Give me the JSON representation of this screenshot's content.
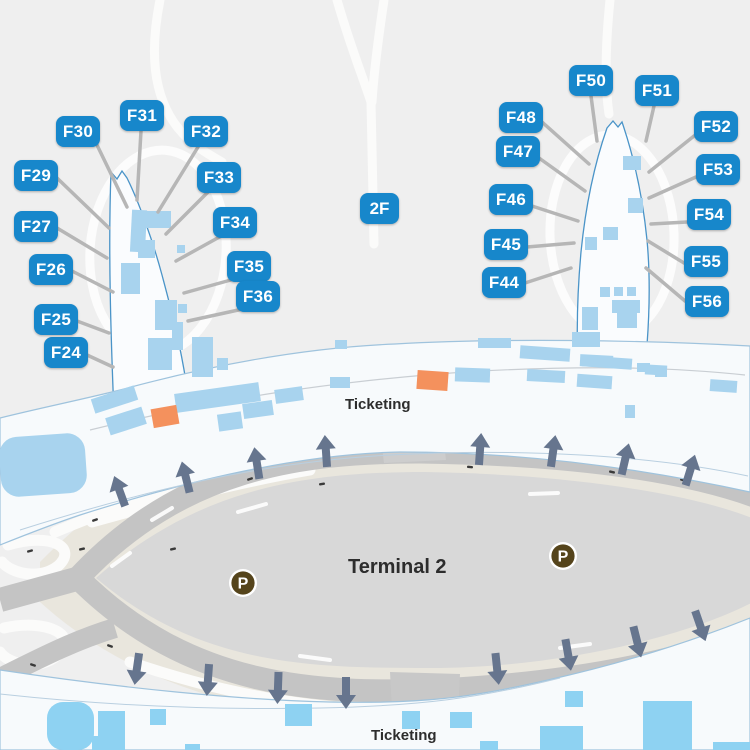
{
  "map": {
    "level_badge": "2F",
    "terminal_label": "Terminal 2",
    "ticketing_upper": "Ticketing",
    "ticketing_lower": "Ticketing",
    "parking_symbol": "P",
    "gates": [
      {
        "id": "F24",
        "x": 44,
        "y": 337,
        "line": [
          87,
          355,
          113,
          367
        ]
      },
      {
        "id": "F25",
        "x": 34,
        "y": 304,
        "line": [
          77,
          321,
          109,
          333
        ]
      },
      {
        "id": "F26",
        "x": 29,
        "y": 254,
        "line": [
          72,
          271,
          113,
          292
        ]
      },
      {
        "id": "F27",
        "x": 14,
        "y": 211,
        "line": [
          57,
          228,
          107,
          258
        ]
      },
      {
        "id": "F29",
        "x": 14,
        "y": 160,
        "line": [
          57,
          178,
          109,
          228
        ]
      },
      {
        "id": "F30",
        "x": 56,
        "y": 116,
        "line": [
          97,
          145,
          127,
          207
        ]
      },
      {
        "id": "F31",
        "x": 120,
        "y": 100,
        "line": [
          141,
          131,
          137,
          200
        ]
      },
      {
        "id": "F32",
        "x": 184,
        "y": 116,
        "line": [
          198,
          147,
          158,
          212
        ]
      },
      {
        "id": "F33",
        "x": 197,
        "y": 162,
        "line": [
          208,
          192,
          166,
          234
        ]
      },
      {
        "id": "F34",
        "x": 213,
        "y": 207,
        "line": [
          223,
          235,
          176,
          261
        ]
      },
      {
        "id": "F35",
        "x": 227,
        "y": 251,
        "line": [
          238,
          278,
          184,
          293
        ]
      },
      {
        "id": "F36",
        "x": 236,
        "y": 281,
        "line": [
          252,
          307,
          188,
          321
        ]
      },
      {
        "id": "F44",
        "x": 482,
        "y": 267,
        "line": [
          525,
          283,
          571,
          268
        ]
      },
      {
        "id": "F45",
        "x": 484,
        "y": 229,
        "line": [
          527,
          247,
          574,
          243
        ]
      },
      {
        "id": "F46",
        "x": 489,
        "y": 184,
        "line": [
          532,
          206,
          578,
          221
        ]
      },
      {
        "id": "F47",
        "x": 496,
        "y": 136,
        "line": [
          539,
          158,
          585,
          191
        ]
      },
      {
        "id": "F48",
        "x": 499,
        "y": 102,
        "line": [
          542,
          122,
          589,
          164
        ]
      },
      {
        "id": "F50",
        "x": 569,
        "y": 65,
        "line": [
          591,
          96,
          597,
          141
        ]
      },
      {
        "id": "F51",
        "x": 635,
        "y": 75,
        "line": [
          654,
          106,
          646,
          141
        ]
      },
      {
        "id": "F52",
        "x": 694,
        "y": 111,
        "line": [
          694,
          136,
          649,
          172
        ]
      },
      {
        "id": "F53",
        "x": 696,
        "y": 154,
        "line": [
          696,
          177,
          649,
          198
        ]
      },
      {
        "id": "F54",
        "x": 687,
        "y": 199,
        "line": [
          687,
          222,
          651,
          224
        ]
      },
      {
        "id": "F55",
        "x": 684,
        "y": 246,
        "line": [
          684,
          263,
          648,
          241
        ]
      },
      {
        "id": "F56",
        "x": 685,
        "y": 286,
        "line": [
          685,
          301,
          646,
          268
        ]
      }
    ],
    "traffic_arrows": {
      "up": [
        [
          120,
          492,
          -20
        ],
        [
          186,
          478,
          -14
        ],
        [
          257,
          464,
          -9
        ],
        [
          326,
          452,
          -4
        ],
        [
          480,
          450,
          4
        ],
        [
          553,
          452,
          8
        ],
        [
          625,
          460,
          13
        ],
        [
          690,
          471,
          17
        ]
      ],
      "down": [
        [
          137,
          668,
          188
        ],
        [
          208,
          679,
          184
        ],
        [
          278,
          687,
          182
        ],
        [
          346,
          692,
          180
        ],
        [
          497,
          668,
          174
        ],
        [
          568,
          654,
          170
        ],
        [
          637,
          641,
          166
        ],
        [
          700,
          625,
          161
        ]
      ]
    },
    "parking_icons": [
      [
        243,
        583
      ],
      [
        563,
        556
      ]
    ],
    "colors": {
      "background": "#efefef",
      "terminal_fill": "#f7fafc",
      "terminal_outline": "#90b9d8",
      "room_blue": "#a8d3ee",
      "room_cyan": "#8ed2f2",
      "highlight_orange": "#f4915d",
      "gate_label_blue": "#1787cb",
      "road_ring_gray": "#c4c4c4",
      "road_inner_gray": "#d8d8d8",
      "curb_beige": "#e9e6dd",
      "arrow_slate": "#66758e",
      "parking_brown": "#55441b",
      "leader_gray": "#b6b6b6",
      "text_dark": "#2d2d2d",
      "road_white": "#fbfbfa"
    }
  }
}
